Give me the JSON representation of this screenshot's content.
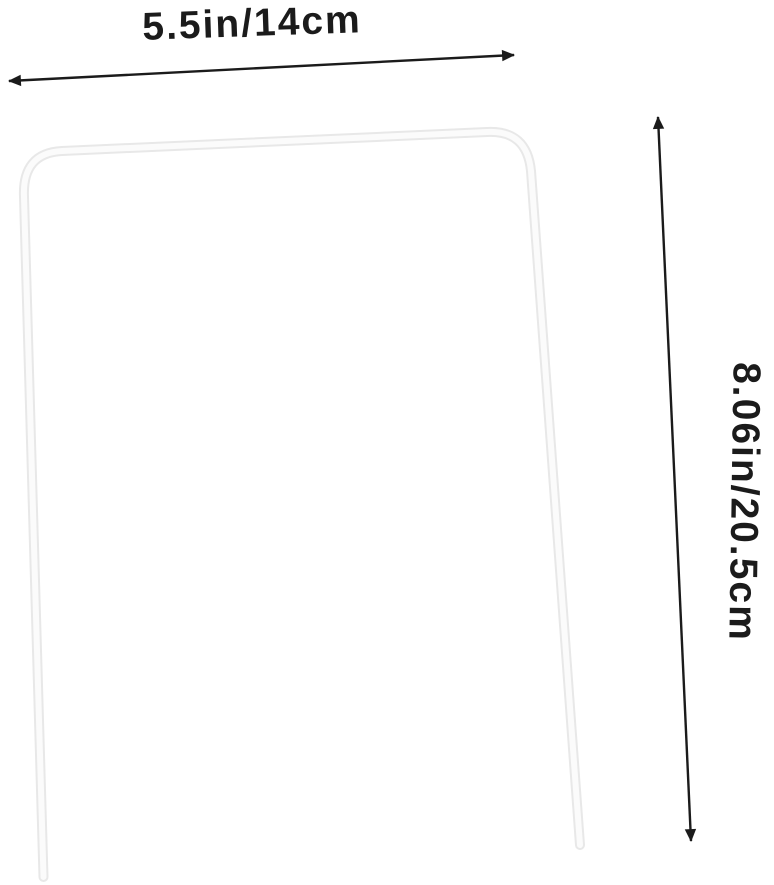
{
  "diagram": {
    "width_label": "5.5in/14cm",
    "height_label": "8.06in/20.5cm"
  },
  "colors": {
    "background": "#ffffff",
    "dimension": "#1b1b1b",
    "wire_outline": "#e8e8e8",
    "wire_body": "#fbfbfb"
  }
}
